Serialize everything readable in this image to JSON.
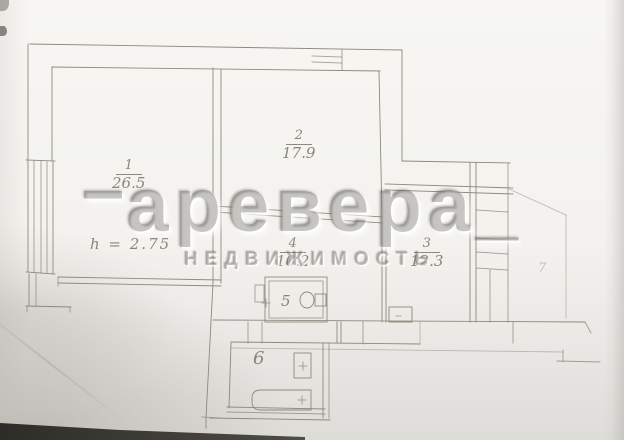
{
  "watermark": {
    "dash": "–",
    "brand": "аревера_",
    "tagline": "НЕДВИЖИМОСТЬ"
  },
  "plan": {
    "height_note": "h = 2.75",
    "rooms": [
      {
        "number": "1",
        "area": "26.5"
      },
      {
        "number": "2",
        "area": "17.9"
      },
      {
        "number": "3",
        "area": "12.3"
      },
      {
        "number": "4",
        "area": "10.2"
      },
      {
        "number": "5"
      },
      {
        "number": "6"
      },
      {
        "number": "7"
      }
    ]
  },
  "colors": {
    "line": "#8f897c",
    "paper": "#f3f2ee",
    "watermark_gray": "#6e6b65",
    "edge_dark": "#2e2c29"
  }
}
